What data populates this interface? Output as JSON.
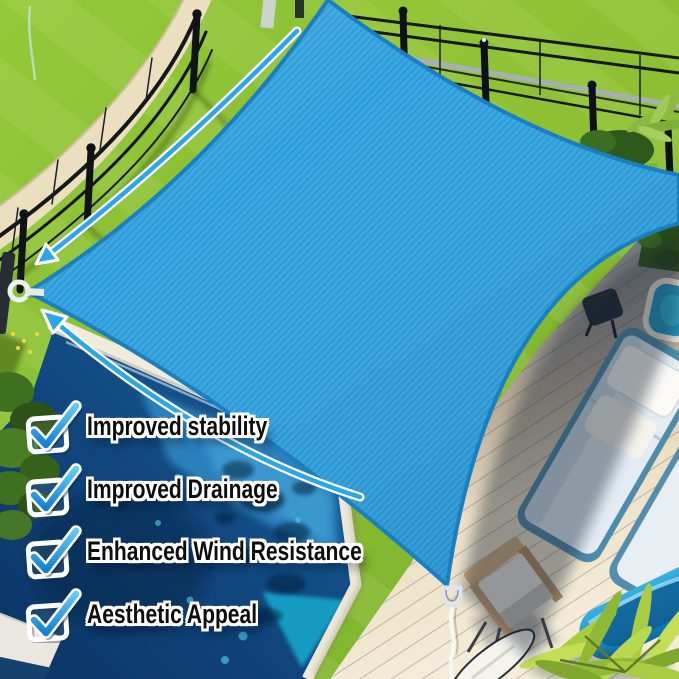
{
  "image": {
    "type": "product-feature-photo",
    "subject": "Blue square sun shade sail installed over a backyard swimming pool and patio deck"
  },
  "features": {
    "items": [
      {
        "icon": "checkbox-checked-icon",
        "label": "Improved stability"
      },
      {
        "icon": "checkbox-checked-icon",
        "label": "Improved Drainage"
      },
      {
        "icon": "checkbox-checked-icon",
        "label": "Enhanced Wind Resistance"
      },
      {
        "icon": "checkbox-checked-icon",
        "label": "Aesthetic Appeal"
      }
    ]
  },
  "icons": {
    "checkbox": "checkbox-checked-icon",
    "arrows": "curved-tension-arrow-icon"
  },
  "colors": {
    "sail_blue": "#34a6e1",
    "sail_hem_blue": "#1a7fc0",
    "check_blue": "#2aa3e8",
    "arrow_blue": "#2ba6e8",
    "text_color": "#0d0d0d",
    "text_outline": "#ffffff",
    "grass_green": "#8abf3a",
    "pool_navy": "#0c3766",
    "pool_light_blue": "#3f9fd4",
    "deck_shadow_gray": "#5c6671",
    "deck_cream": "#f0e4cb",
    "path_cream": "#ecdfc0"
  }
}
